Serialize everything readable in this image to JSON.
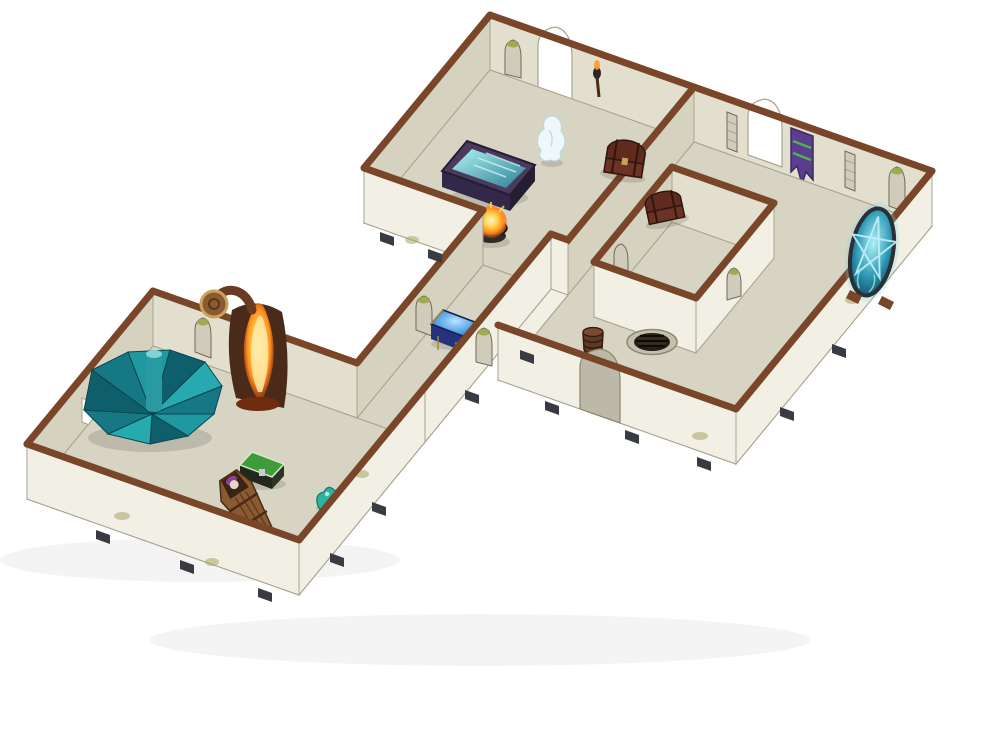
{
  "scene": {
    "description": "Photograph of a painted modular dungeon terrain kit on a white background: isometric stone-brick rooms with brown-capped walls. A crypt hall with glowing sarcophagus, ghost and fire brazier; a ritual chamber with pentagram portal, banner, barrel and floor well; an enclosed inner vault; a corridor with an arcane blue chest; and a conjurer's den with teal spiral staircase, forge fire, green chest and a wooden coffin with a vampire.",
    "background_label": "white studio backdrop",
    "rooms": [
      {
        "name": "crypt-hall"
      },
      {
        "name": "ritual-chamber"
      },
      {
        "name": "inner-vault"
      },
      {
        "name": "corridor"
      },
      {
        "name": "conjurers-den"
      }
    ],
    "props": [
      {
        "name": "treasure-chest"
      },
      {
        "name": "fallen-chest"
      },
      {
        "name": "glowing-sarcophagus"
      },
      {
        "name": "ghost-miniature"
      },
      {
        "name": "fire-brazier"
      },
      {
        "name": "wall-banner"
      },
      {
        "name": "pentagram-portal"
      },
      {
        "name": "barrel"
      },
      {
        "name": "floor-well-grate"
      },
      {
        "name": "arcane-blue-chest"
      },
      {
        "name": "spiral-staircase"
      },
      {
        "name": "forge-fire"
      },
      {
        "name": "green-chest"
      },
      {
        "name": "wooden-coffin-with-vampire"
      },
      {
        "name": "slime-blob"
      }
    ]
  },
  "colors": {
    "background": "#ffffff",
    "wall_exterior": "#f2efe5",
    "wall_interior": "#e3dfcf",
    "wall_interior_dark": "#d6d2c0",
    "wall_cap": "#7a4629",
    "floor": "#d8d4c3",
    "floor_line": "#8d8874",
    "brick_line": "#6f6a58",
    "line": "#a9a491",
    "arch_white": "#ffffff",
    "arch_shadow": "#bdb9a8",
    "niche_fill": "#d0ccbb",
    "moss": "#97a53f",
    "moss_soft": "#a8a562",
    "clip": "#383b42",
    "ghost": "#eef7f9",
    "ghost_line": "#b9d8de",
    "ember_base": "#2e2a26",
    "bowl": "#3c3430",
    "sarc_body": "#4a3a5e",
    "sarc_front": "#32284a",
    "sarc_side": "#241d33",
    "chest_wood": "#6b3326",
    "chest_lid": "#5e2b1e",
    "chest_dark": "#33150c",
    "chest_trim": "#c9a25a",
    "banner": "#5b3e8f",
    "banner_stripe": "#55b04a",
    "banner_line": "#3c2a60",
    "portal_frame": "#2b2f36",
    "portal_star": "#bfeffa",
    "portal_halo": "#7fd8e8",
    "stand_brown": "#7a4629",
    "barrel_body": "#5e3a28",
    "barrel_top": "#7a4a30",
    "barrel_line": "#33190e",
    "well_rim": "#c5c0ae",
    "well_hole": "#241f19",
    "well_inner": "#3a3126",
    "well_slat": "#0f0c08",
    "bluechest_body": "#23337e",
    "bluechest_side": "#1a2860",
    "bluechest_trim": "#b08830",
    "bluechest_edge": "#14204e",
    "stair_a": "#157884",
    "stair_b": "#1f98a0",
    "stair_c": "#0e5f6b",
    "stair_d": "#26aab0",
    "stair_line": "#0a464f",
    "stair_pole": "#2a9aa2",
    "stair_pole_top": "#7fd4d4",
    "forge_char": "#4a2a18",
    "horn_brown": "#6b3a22",
    "shield_wood": "#8a5a32",
    "shield_trim": "#caa258",
    "ember_red": "#712c10",
    "green_lid": "#3f9c3a",
    "green_body": "#23281f",
    "green_side": "#2e3328",
    "green_edge": "#d9e8d2",
    "lock_metal": "#c9ccd2",
    "coffin_wood": "#8a5a32",
    "coffin_line": "#5a3618",
    "coffin_edge": "#4a2a12",
    "coffin_hole": "#3a2414",
    "vampire_hair": "#8a3f8f",
    "vampire_face": "#e0d6cc",
    "slime": "#2bb5a0",
    "slime_line": "#157a6e",
    "torch_wood": "#4a2a12",
    "torch_head": "#2e2620",
    "flame": "#ff9a2a"
  }
}
